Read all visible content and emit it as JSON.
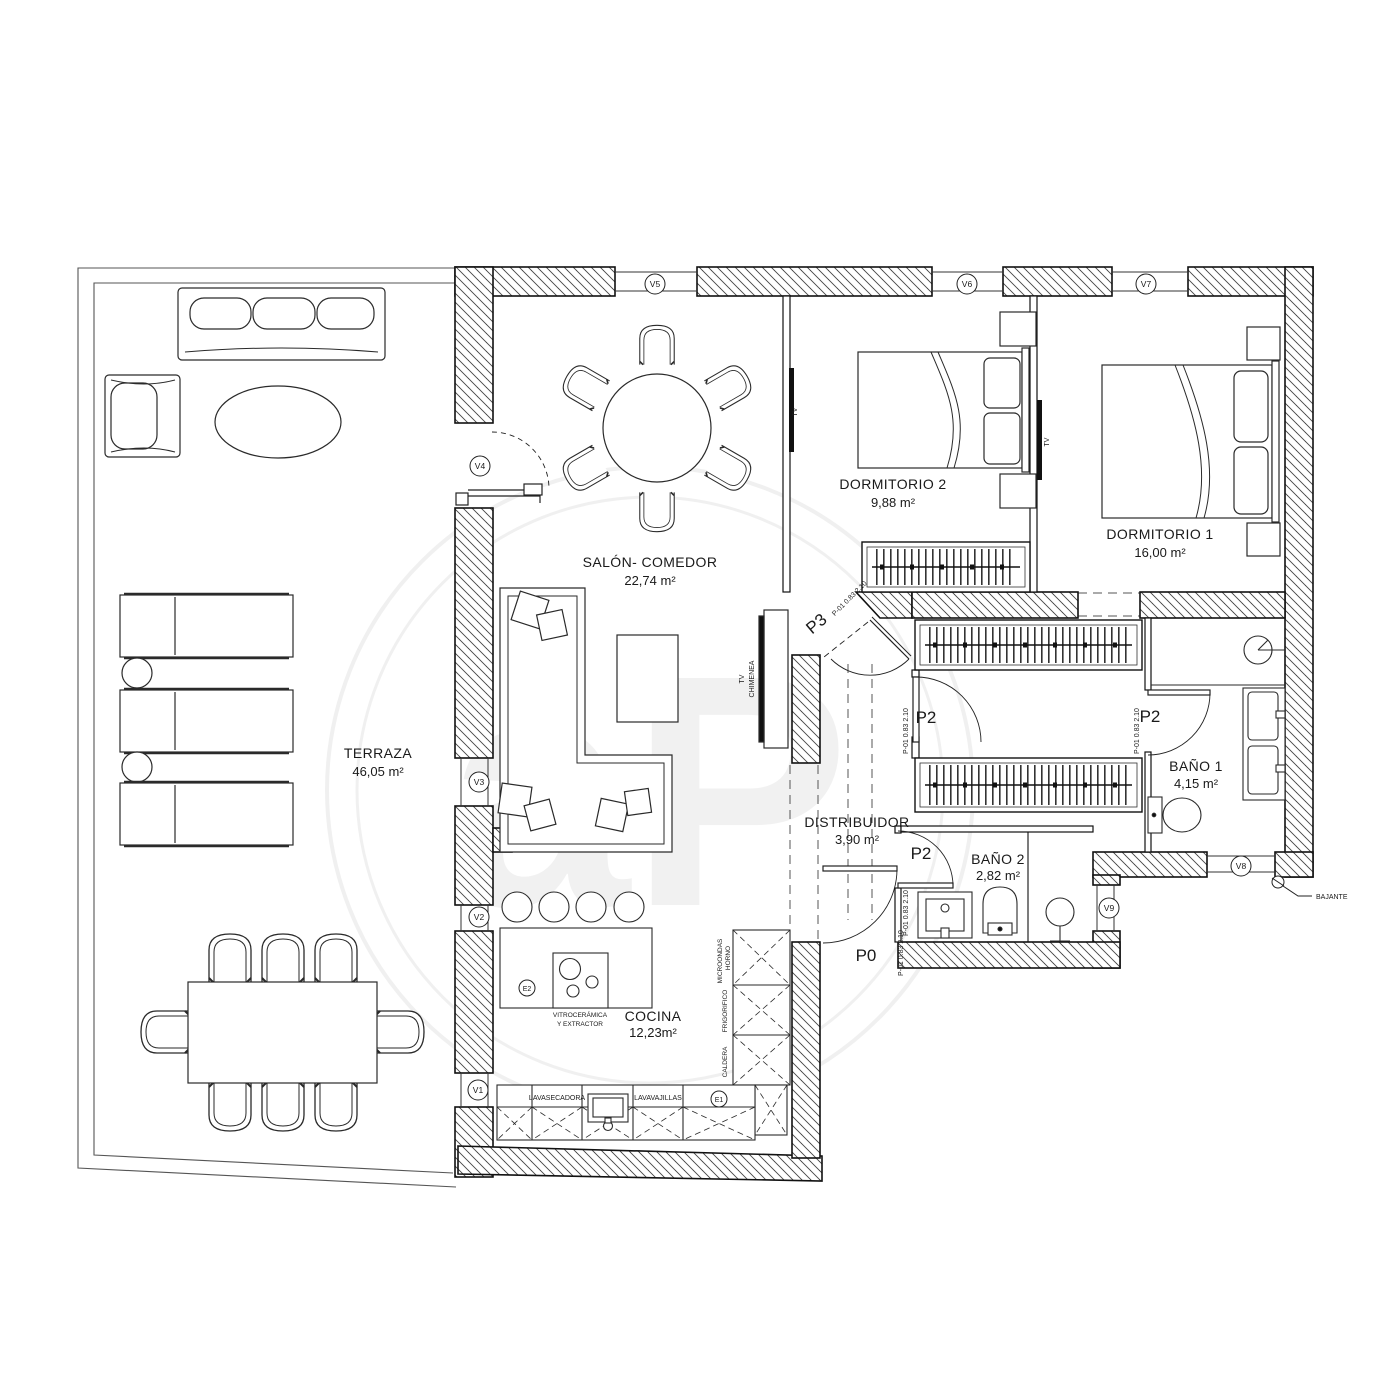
{
  "plan_title": "Floor plan",
  "rooms": {
    "terraza": {
      "name": "TERRAZA",
      "area": "46,05 m²"
    },
    "salon": {
      "name": "SALÓN- COMEDOR",
      "area": "22,74 m²"
    },
    "dormitorio2": {
      "name": "DORMITORIO 2",
      "area": "9,88 m²"
    },
    "dormitorio1": {
      "name": "DORMITORIO 1",
      "area": "16,00 m²"
    },
    "bano1": {
      "name": "BAÑO 1",
      "area": "4,15 m²"
    },
    "bano2": {
      "name": "BAÑO 2",
      "area": "2,82 m²"
    },
    "distribuidor": {
      "name": "DISTRIBUIDOR",
      "area": "3,90 m²"
    },
    "cocina": {
      "name": "COCINA",
      "area": "12,23m²"
    }
  },
  "windows": {
    "v1": "V1",
    "v2": "V2",
    "v3": "V3",
    "v4": "V4",
    "v5": "V5",
    "v6": "V6",
    "v7": "V7",
    "v8": "V8",
    "v9": "V9"
  },
  "doors": {
    "p0": "P0",
    "p2": "P2",
    "p3": "P3",
    "dim": "P-01 0.83  2.10"
  },
  "equipment": {
    "e1": "E1",
    "e2": "E2",
    "tv": "TV",
    "chimenea": "CHIMENEA",
    "bajante": "BAJANTE",
    "vitro_line1": "VITROCERÁMICA",
    "vitro_line2": "Y EXTRACTOR",
    "lavasecadora": "LAVASECADORA",
    "lavavajillas": "LAVAVAJILLAS",
    "microondas": "MICROONDAS",
    "horno": "HORNO",
    "frigorifico": "FRIGORIFICO",
    "caldera": "CALDERA"
  },
  "watermark": {
    "text": "aP"
  },
  "colors": {
    "line": "#1a1a1a",
    "wall_fill": "#ffffff",
    "background": "#ffffff"
  }
}
